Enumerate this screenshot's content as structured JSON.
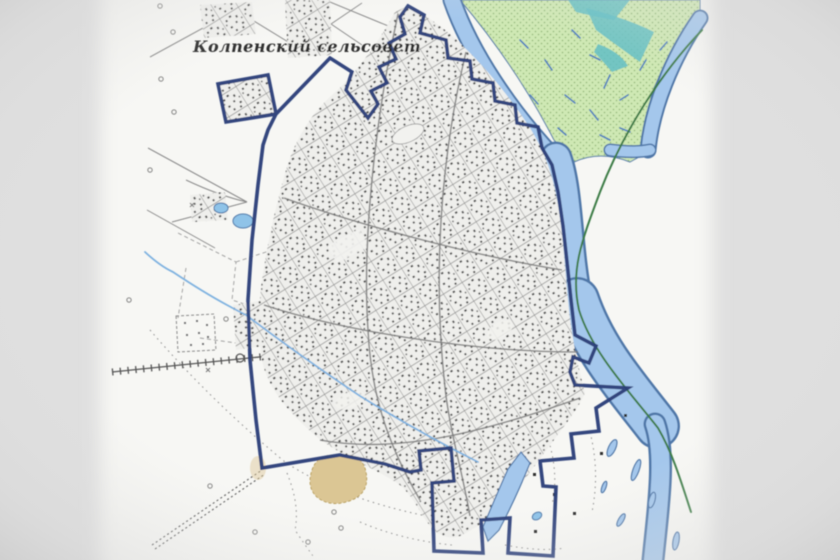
{
  "map": {
    "area_label": "Колпенский сельсовет",
    "features": [
      {
        "name": "settlement-boundary",
        "type": "administrative-boundary-line"
      },
      {
        "name": "urban-area",
        "type": "built-up-settlement-blocks"
      },
      {
        "name": "annex-parcel",
        "type": "outlying-settlement-block"
      },
      {
        "name": "river",
        "type": "river-with-branches"
      },
      {
        "name": "marsh-area",
        "type": "floodplain-marsh-vegetation"
      },
      {
        "name": "riverside-route",
        "type": "green-route-line"
      },
      {
        "name": "railway-spur",
        "type": "hatched-railway-line"
      },
      {
        "name": "field-track",
        "type": "dotted-track"
      },
      {
        "name": "cemetery",
        "type": "hatched-plot"
      },
      {
        "name": "sand-pit",
        "type": "sand-patch"
      },
      {
        "name": "oxbow-lake",
        "type": "narrow-lake"
      },
      {
        "name": "ponds",
        "type": "small-ponds"
      },
      {
        "name": "stream",
        "type": "stream-through-settlement"
      }
    ]
  },
  "colors": {
    "background": "#dfdfdf",
    "paper": "#f7f7f4",
    "boundary": "#2c3f79",
    "river_fill": "#a4c7ec",
    "river_edge": "#4f77a8",
    "marsh_fill": "#cfe8b4",
    "marsh_dot": "#7fa968",
    "marsh_teal": "#63bec4",
    "riverside_route": "#3e7d46",
    "urban_base": "#efefec",
    "urban_speckle": "#4c4c4c",
    "road": "#8a8a8a",
    "railway": "#555555",
    "sand_fill": "#dbc694",
    "sand_edge": "#b59b55",
    "stream": "#7fb2e0",
    "pond_fill": "#8fc3e8",
    "label_text": "#2e2e2e"
  }
}
